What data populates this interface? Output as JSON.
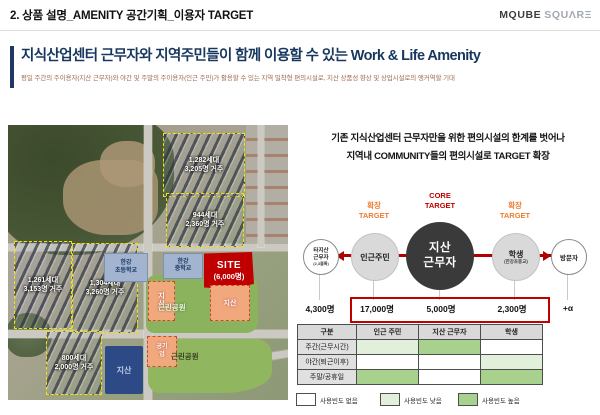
{
  "header": {
    "page_title": "2. 상품 설명_AMENITY 공간기획_이용자 TARGET",
    "logo_primary": "MQUBE",
    "logo_secondary": "SQUΛRΞ"
  },
  "section": {
    "title": "지식산업센터 근무자와 지역주민들이 함께 이용할 수 있는 Work & Life Amenity",
    "subtitle": "평일 주간의 주이용자(지산 근무자)와 야간 및 주말의 주이용자(인근 주민)가 활용할 수 있는 지역 밀착형 편의시설로, 지산 상품성 향상 및 상업시설로의 앵커역할 기대"
  },
  "map": {
    "blocks": [
      {
        "units": "1,282세대",
        "residents": "3,205명 거주"
      },
      {
        "units": "944세대",
        "residents": "2,360명 거주"
      },
      {
        "units": "1,261세대",
        "residents": "3,153명 거주"
      },
      {
        "units": "1,304세대",
        "residents": "3,260명 거주"
      },
      {
        "units": "800세대",
        "residents": "2,000명 거주"
      }
    ],
    "schools": [
      {
        "line1": "한강",
        "line2": "초등학교"
      },
      {
        "line1": "한강",
        "line2": "중학교"
      }
    ],
    "site": {
      "label": "SITE",
      "sub": "(6,000명)"
    },
    "industry_left": "지산",
    "industry_right": "지산",
    "industry_blue": "지산",
    "public_company": "공기업",
    "park_upper": "근린공원",
    "park_lower": "근린공원"
  },
  "target": {
    "intro_line1": "기존 지식산업센터 근무자만을 위한 편의시설의 한계를 벗어나",
    "intro_line2": "지역내 COMMUNITY들의 편의시설로 TARGET 확장",
    "core_label_line1": "CORE",
    "core_label_line2": "TARGET",
    "expand_line1": "확장",
    "expand_line2": "TARGET",
    "circles": {
      "other_workers": {
        "line1": "타지산",
        "line2": "근무자",
        "sub": "(2,3블록)",
        "count": "4,300명"
      },
      "neighbors": {
        "label": "인근주민",
        "count": "17,000명"
      },
      "core": {
        "line1": "지산",
        "line2": "근무자",
        "count": "5,000명"
      },
      "students": {
        "label": "학생",
        "sub": "(한강초중교)",
        "count": "2,300명"
      },
      "visitors": {
        "label": "방문자",
        "count": "+α"
      }
    }
  },
  "table": {
    "headers": [
      "구분",
      "인근 주민",
      "지산 근무자",
      "학생"
    ],
    "rows": [
      {
        "label": "주간(근무시간)",
        "cells": [
          "low",
          "high",
          "none"
        ]
      },
      {
        "label": "야간(퇴근이후)",
        "cells": [
          "none",
          "none",
          "low"
        ]
      },
      {
        "label": "주말/공휴일",
        "cells": [
          "high",
          "none",
          "high"
        ]
      }
    ],
    "legend": [
      {
        "level": "none",
        "label": "사용빈도 없음"
      },
      {
        "level": "low",
        "label": "사용빈도 낮음"
      },
      {
        "level": "high",
        "label": "사용빈도 높음"
      }
    ]
  },
  "colors": {
    "none": "#FFFFFF",
    "low": "#E2EFDA",
    "high": "#A9D18E",
    "accent_red": "#C00000",
    "accent_orange": "#ED7D31",
    "navy": "#1F3864"
  }
}
